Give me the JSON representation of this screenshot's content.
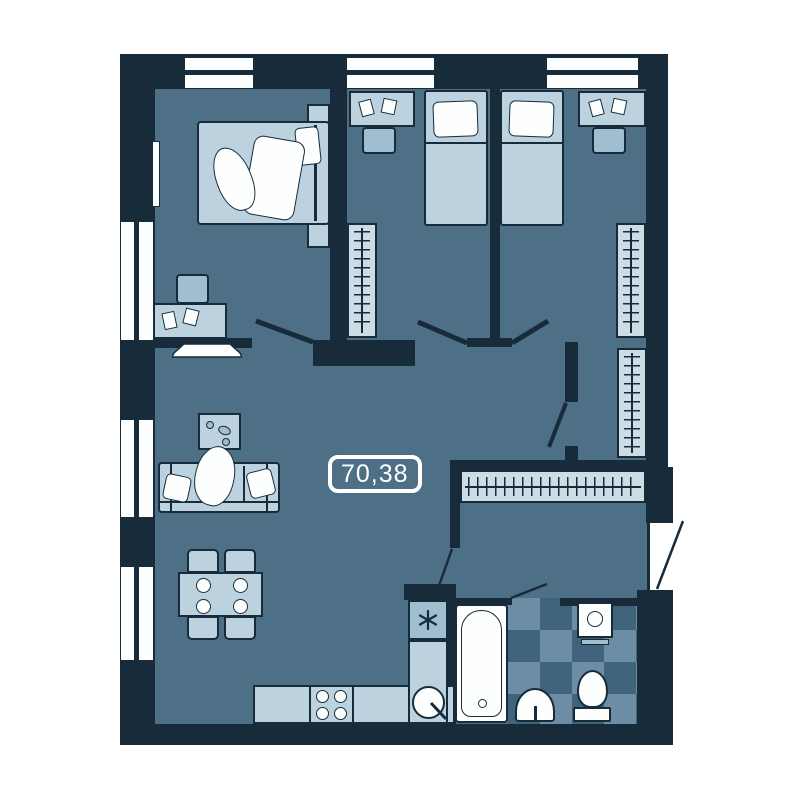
{
  "plan": {
    "area_label": "70,38",
    "colors": {
      "background": "#ffffff",
      "wall": "#172b3b",
      "floor": "#4d7086",
      "furn": "#bcd2df",
      "furn2": "#9fbed0",
      "ward": "#cddde6",
      "tile-d": "#3f637b",
      "tile-l": "#6c8da4",
      "white": "#fdfefe"
    },
    "fixtures": [
      "double-bed",
      "single-bed",
      "desk",
      "chair",
      "wardrobe",
      "coat-rack",
      "sofa",
      "coffee-table",
      "tv",
      "dining-table",
      "kitchen-counter",
      "stove",
      "fridge",
      "kitchen-sink",
      "bathtub",
      "wash-basin",
      "toilet",
      "washing-machine",
      "mirror"
    ]
  }
}
